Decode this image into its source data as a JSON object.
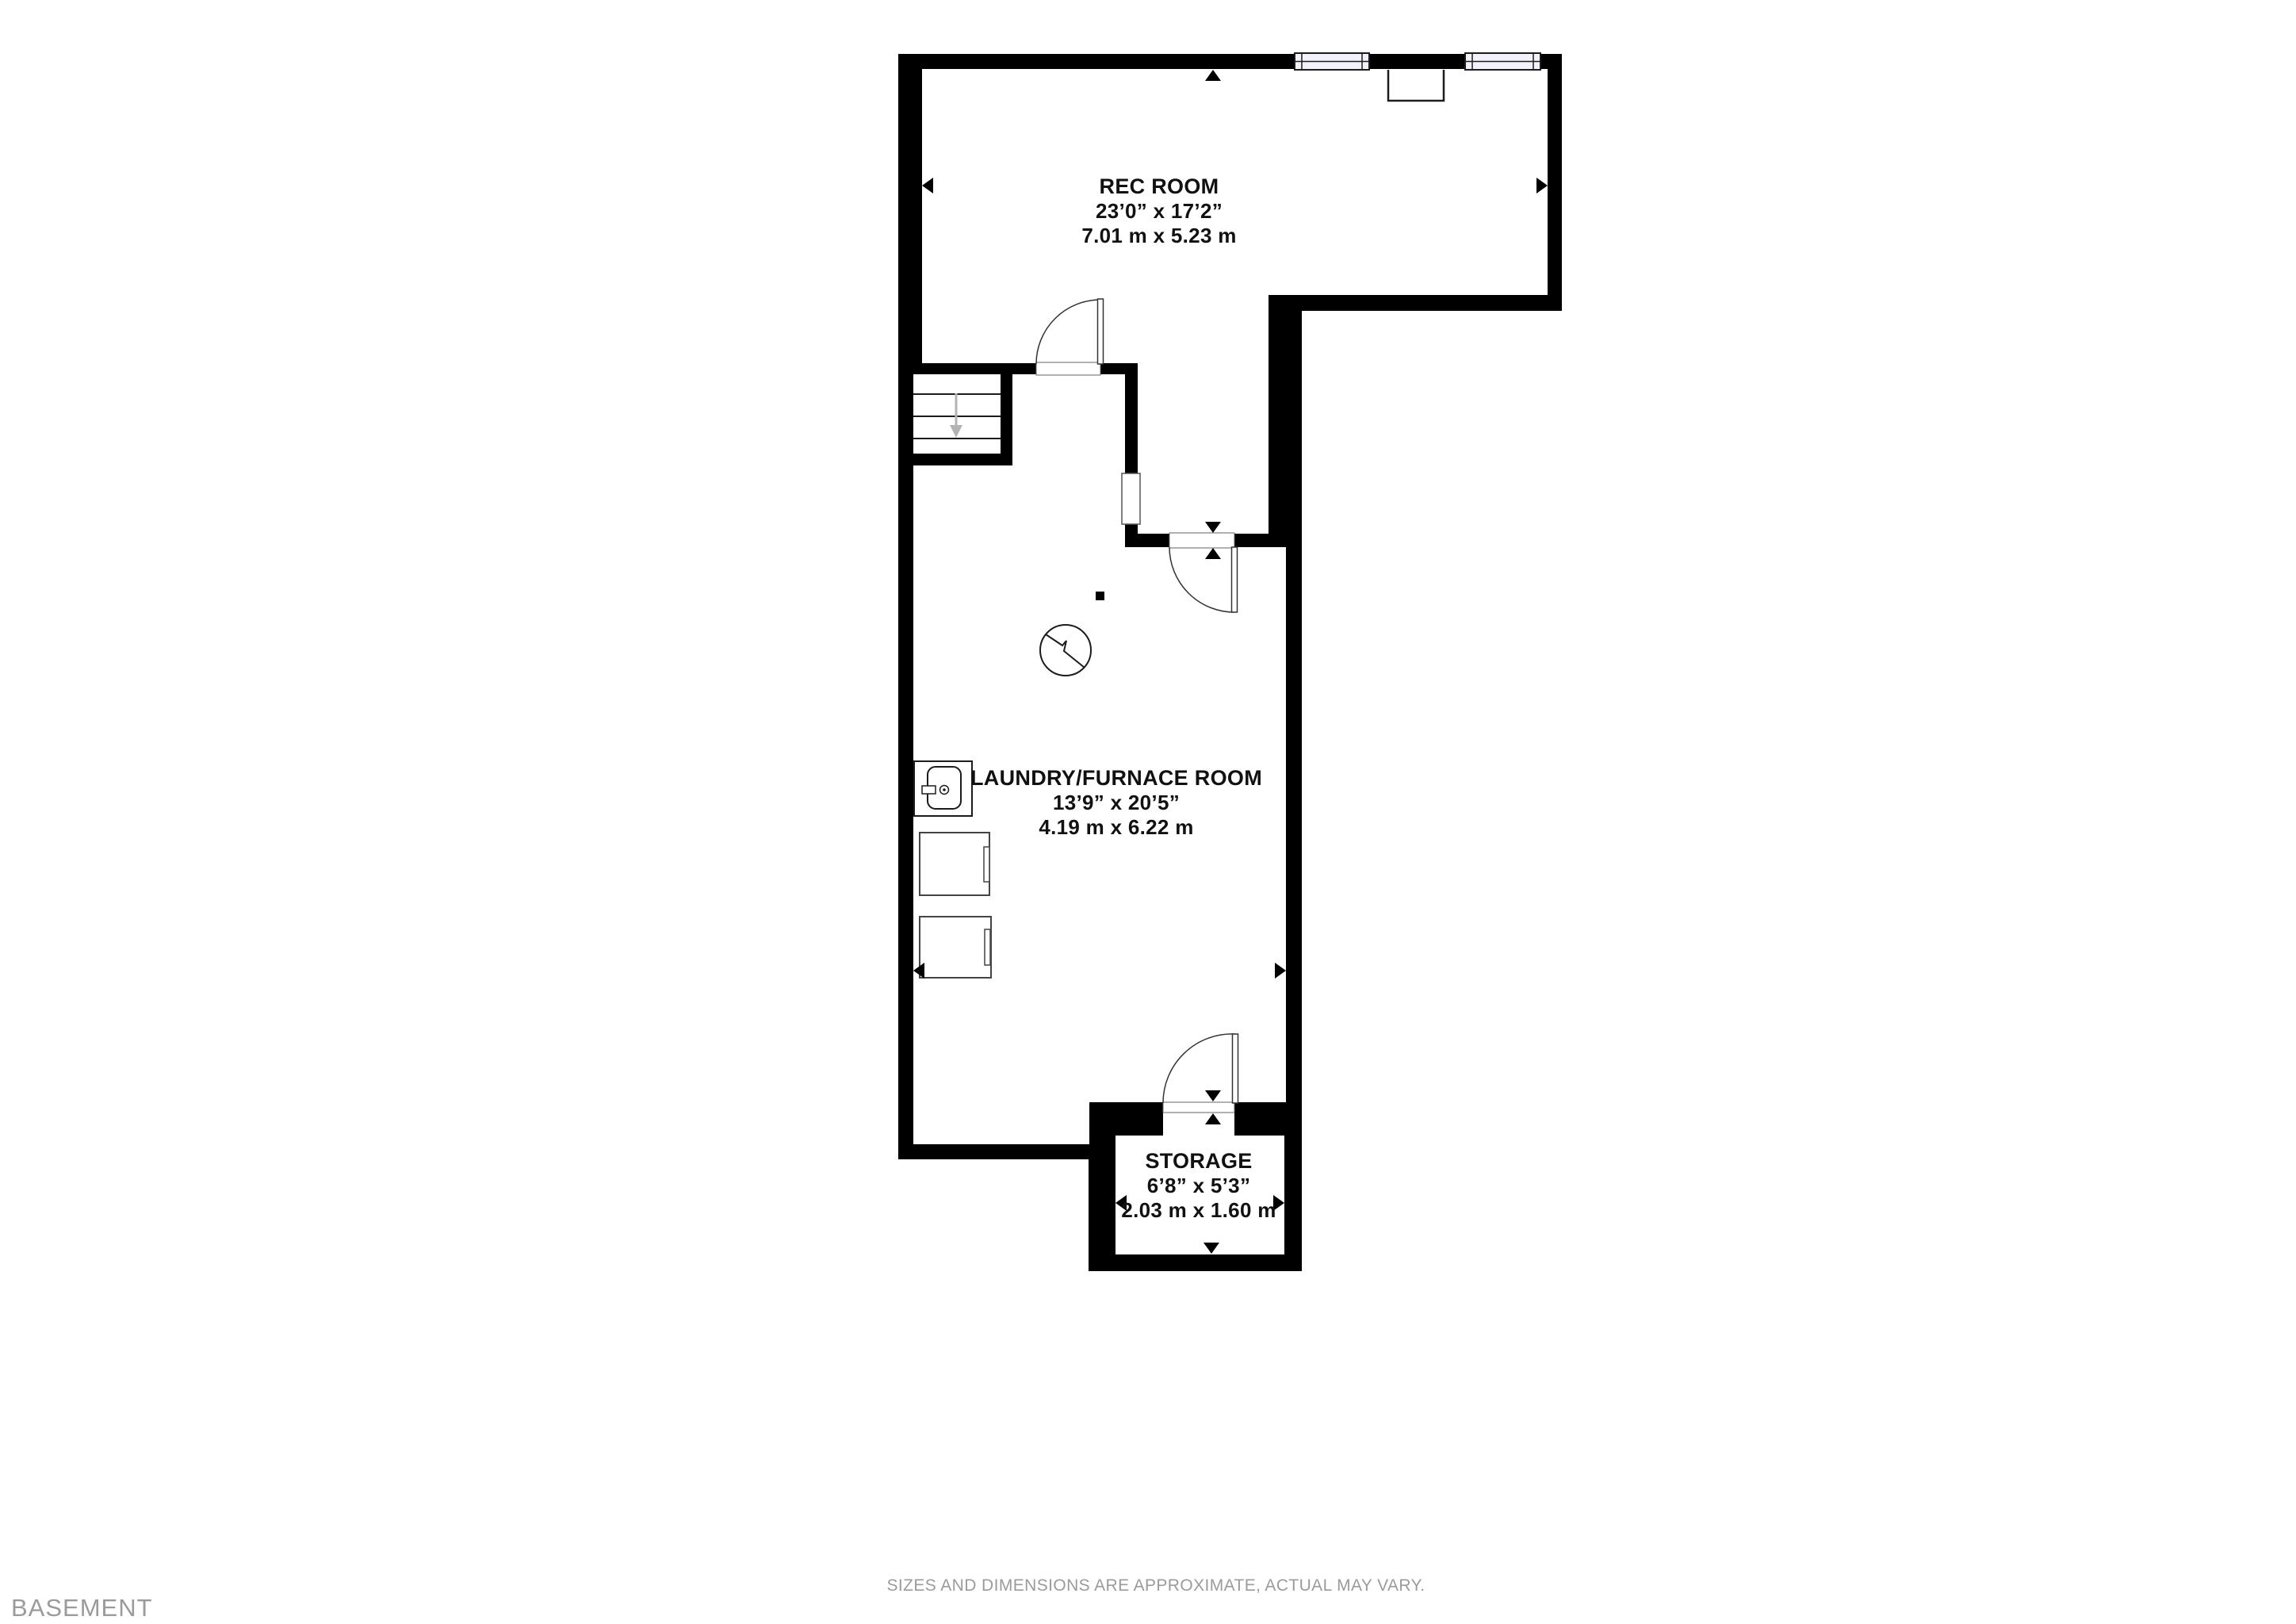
{
  "footer": {
    "floor_label": "BASEMENT",
    "disclaimer": "SIZES AND DIMENSIONS ARE APPROXIMATE, ACTUAL MAY VARY."
  },
  "rooms": [
    {
      "id": "rec-room",
      "name": "REC ROOM",
      "imperial": "23’0” x 17’2”",
      "metric": "7.01 m x 5.23 m"
    },
    {
      "id": "laundry-furnace-room",
      "name": "LAUNDRY/FURNACE ROOM",
      "imperial": "13’9” x 20’5”",
      "metric": "4.19 m x 6.22 m"
    },
    {
      "id": "storage",
      "name": "STORAGE",
      "imperial": "6’8” x 5’3”",
      "metric": "2.03 m x 1.60 m"
    }
  ],
  "icons": [
    "staircase-down-arrow-icon",
    "door-swing-icon",
    "window-icon",
    "furnace-icon",
    "laundry-sink-icon",
    "washer-icon",
    "dryer-icon",
    "support-post-icon",
    "fireplace-icon",
    "dimension-arrow-icon"
  ],
  "colors": {
    "wall": "#000000",
    "line": "#1c1c1c",
    "gray_text": "#9b9b9b",
    "label": "#111111",
    "window_fill": "#f2f2fa",
    "stair_arrow": "#b3b3b3"
  }
}
